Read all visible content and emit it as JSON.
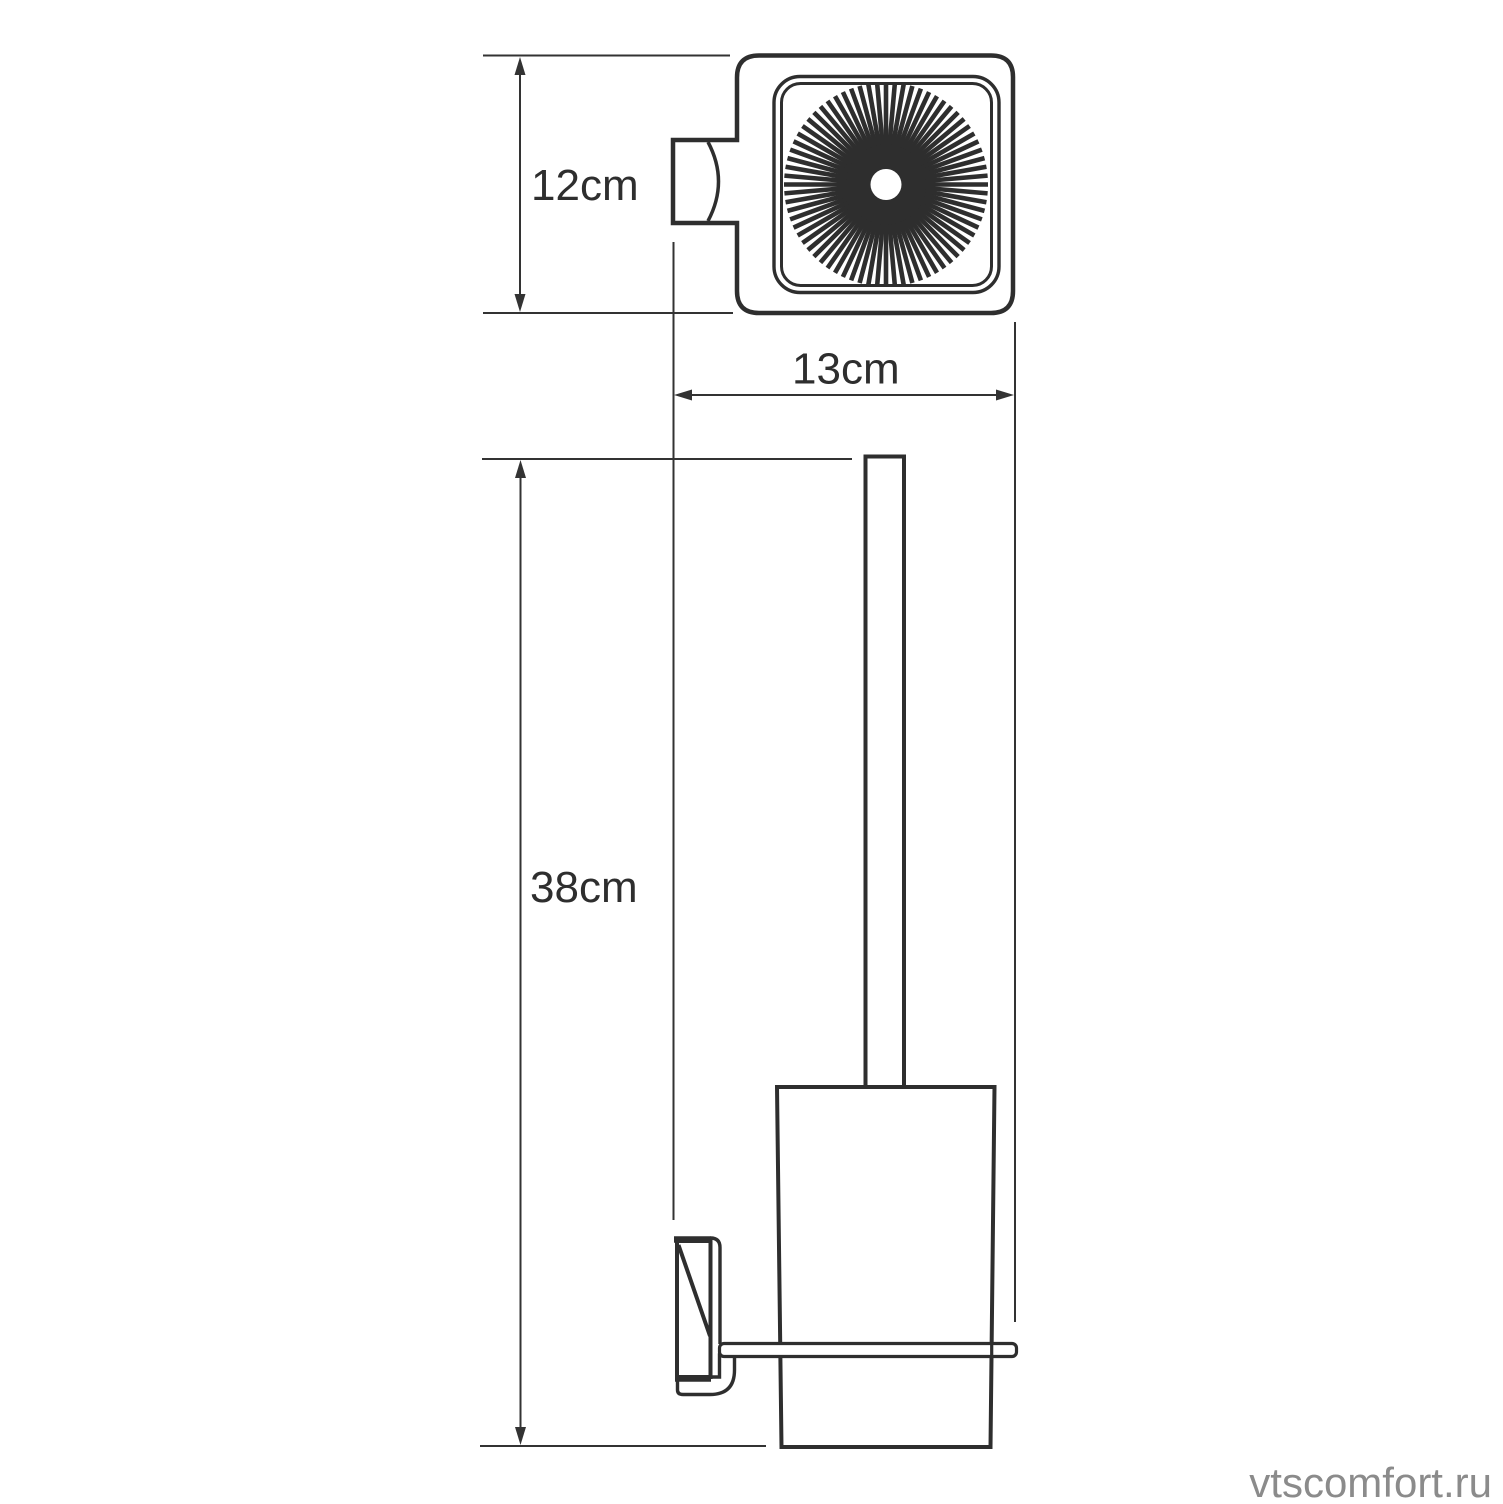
{
  "diagram": {
    "type": "technical-drawing",
    "subject": "wall-mounted-toilet-brush-holder",
    "labels": {
      "top_view_height": "12cm",
      "top_view_depth": "13cm",
      "front_view_height": "38cm"
    },
    "watermark": "vtscomfort.ru",
    "colors": {
      "line": "#2e2e2e",
      "thin_line": "#333333",
      "watermark": "#8b8b8b",
      "background": "#ffffff"
    }
  }
}
